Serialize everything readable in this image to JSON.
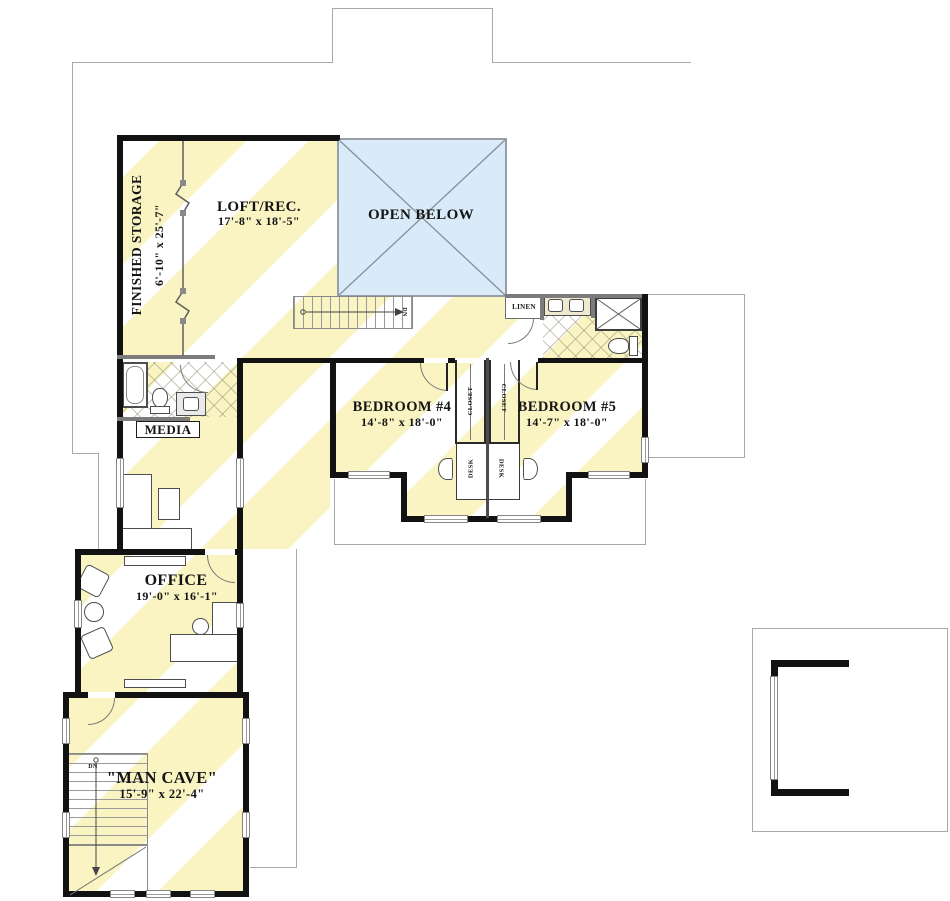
{
  "plan": {
    "rooms": {
      "finished_storage": {
        "name": "FINISHED STORAGE",
        "dims": "6'-10\" x 25'-7\""
      },
      "loft_rec": {
        "name": "LOFT/REC.",
        "dims": "17'-8\" x 18'-5\""
      },
      "open_below": {
        "name": "OPEN BELOW"
      },
      "bedroom_4": {
        "name": "BEDROOM #4",
        "dims": "14'-8\" x 18'-0\""
      },
      "bedroom_5": {
        "name": "BEDROOM #5",
        "dims": "14'-7\" x 18'-0\""
      },
      "office": {
        "name": "OFFICE",
        "dims": "19'-0\" x 16'-1\""
      },
      "man_cave": {
        "name": "\"MAN CAVE\"",
        "dims": "15'-9\" x 22'-4\""
      },
      "media": {
        "name": "MEDIA"
      },
      "linen": {
        "name": "LINEN"
      }
    },
    "labels": {
      "closet": "CLOSET",
      "desk": "DESK",
      "down": "DN"
    },
    "colors": {
      "stripe_yellow": "#faf3c2",
      "open_below_blue": "#d9eaf8",
      "wall": "#121212",
      "gray_wall": "#7c7c7c",
      "outline": "#a8a8a8"
    }
  }
}
